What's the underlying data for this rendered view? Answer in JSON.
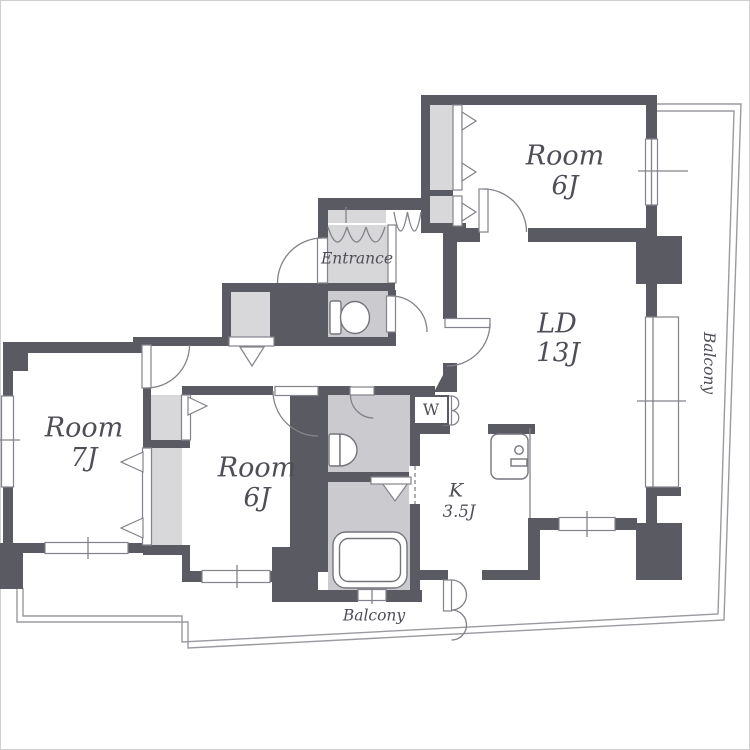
{
  "plan": {
    "title": "apartment-floor-plan",
    "rooms": [
      {
        "name": "Room",
        "size": "6J",
        "location": "top-right"
      },
      {
        "name": "LD",
        "size": "13J",
        "location": "right"
      },
      {
        "name": "Room",
        "size": "7J",
        "location": "left"
      },
      {
        "name": "Room",
        "size": "6J",
        "location": "bottom-center"
      },
      {
        "name": "K",
        "size": "3.5J",
        "location": "center"
      }
    ],
    "labels": {
      "entrance": "Entrance",
      "balcony_right": "Balcony",
      "balcony_bottom": "Balcony",
      "washing_machine": "W"
    },
    "colors": {
      "wall": "#5a5a62",
      "closet": "#d8d8db",
      "wet": "#cbcbcf",
      "genkan": "#d7d7da",
      "line": "#82828a",
      "text": "#4e4e56"
    }
  }
}
